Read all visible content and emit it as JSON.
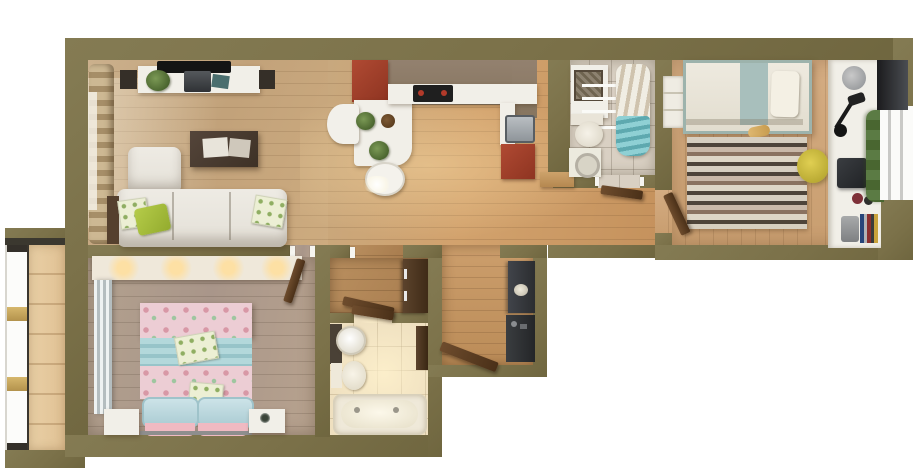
{
  "scene": {
    "kind": "photoreal-3d-floor-plan-render",
    "view": "top-down",
    "background_color": "#ffffff",
    "no_visible_text": true
  },
  "palette": {
    "wall_olive": "#7b7149",
    "floor_main_tan": "#d2a26d",
    "floor_living": "#c7a87f",
    "floor_bedroom_right": "#cfa679",
    "floor_bedroom_left_gray": "#ae9b8c",
    "floor_balcony": "#e5c99e",
    "tile_bath_top": "#d9d0c3",
    "tile_bath_bottom": "#efe0c0",
    "kitchen_cabinet_red": "#a6402d",
    "kitchen_counter_white": "#f2f0e9",
    "kitchen_backsplash_taupe": "#8c7a69",
    "sofa_white": "#e9e6df",
    "coffee_table_brown": "#4a3c30",
    "accent_lime_pillow": "#a9c23f",
    "bed_right_teal_band": "#a8bfbc",
    "rug_stripe_dark": "#4e443a",
    "stool_yellow": "#d6c63e",
    "bed_left_pink_floral": "#eccdd4",
    "bed_left_teal_band": "#a9d2d6",
    "pillow_blue": "#c3dde3",
    "pillow_pink": "#f0bac2",
    "towel_teal": "#86c7cc",
    "door_wood_brown": "#5a3a22",
    "entry_console_dark": "#35383b"
  },
  "rooms": [
    {
      "id": "living-room",
      "area": "top-left",
      "furniture": [
        "curtained-window",
        "tv-sideboard",
        "tv",
        "speakers",
        "plant",
        "laptop",
        "coffee-table",
        "magazines",
        "corner-sofa",
        "green-cushions"
      ]
    },
    {
      "id": "kitchen",
      "area": "top-center",
      "furniture": [
        "red-upper-cabinet",
        "white-bar-table",
        "bar-chairs",
        "potted-herbs",
        "worktop",
        "cooktop",
        "sink",
        "red-lower-cabinet",
        "wood-bench"
      ]
    },
    {
      "id": "bathroom-top",
      "area": "top-right-center",
      "furniture": [
        "vanity-sink",
        "wall-basket",
        "towel-bars",
        "toilet",
        "washing-machine",
        "drying-rack",
        "teal-towels"
      ]
    },
    {
      "id": "bedroom-right",
      "area": "top-right",
      "furniture": [
        "single-bed",
        "teal-runner",
        "pillow",
        "open-shelf",
        "striped-rug",
        "yellow-stool",
        "desk",
        "desk-lamp",
        "monitor",
        "desk-chair",
        "books",
        "plant-garland",
        "window",
        "tv-panel"
      ]
    },
    {
      "id": "bedroom-left",
      "area": "bottom-left",
      "furniture": [
        "built-in-wardrobe",
        "mirror-curtain",
        "double-bed-pink-floral",
        "teal-runner",
        "blue-pillows",
        "pink-pillows",
        "nightstand-left",
        "nightstand-right",
        "alarm-clock"
      ]
    },
    {
      "id": "closet-anteroom",
      "area": "bottom-center",
      "furniture": [
        "brown-cabinet",
        "open-door"
      ]
    },
    {
      "id": "bathroom-bottom",
      "area": "bottom-center",
      "furniture": [
        "round-sink-vanity",
        "toilet",
        "bathtub",
        "wall-shelf"
      ]
    },
    {
      "id": "entry-hall",
      "area": "bottom-center-right",
      "furniture": [
        "console-upper",
        "decor-bowl",
        "console-lower",
        "entrance-door"
      ]
    },
    {
      "id": "balcony",
      "area": "left",
      "furniture": [
        "glazed-windows",
        "wood-decking"
      ]
    }
  ]
}
